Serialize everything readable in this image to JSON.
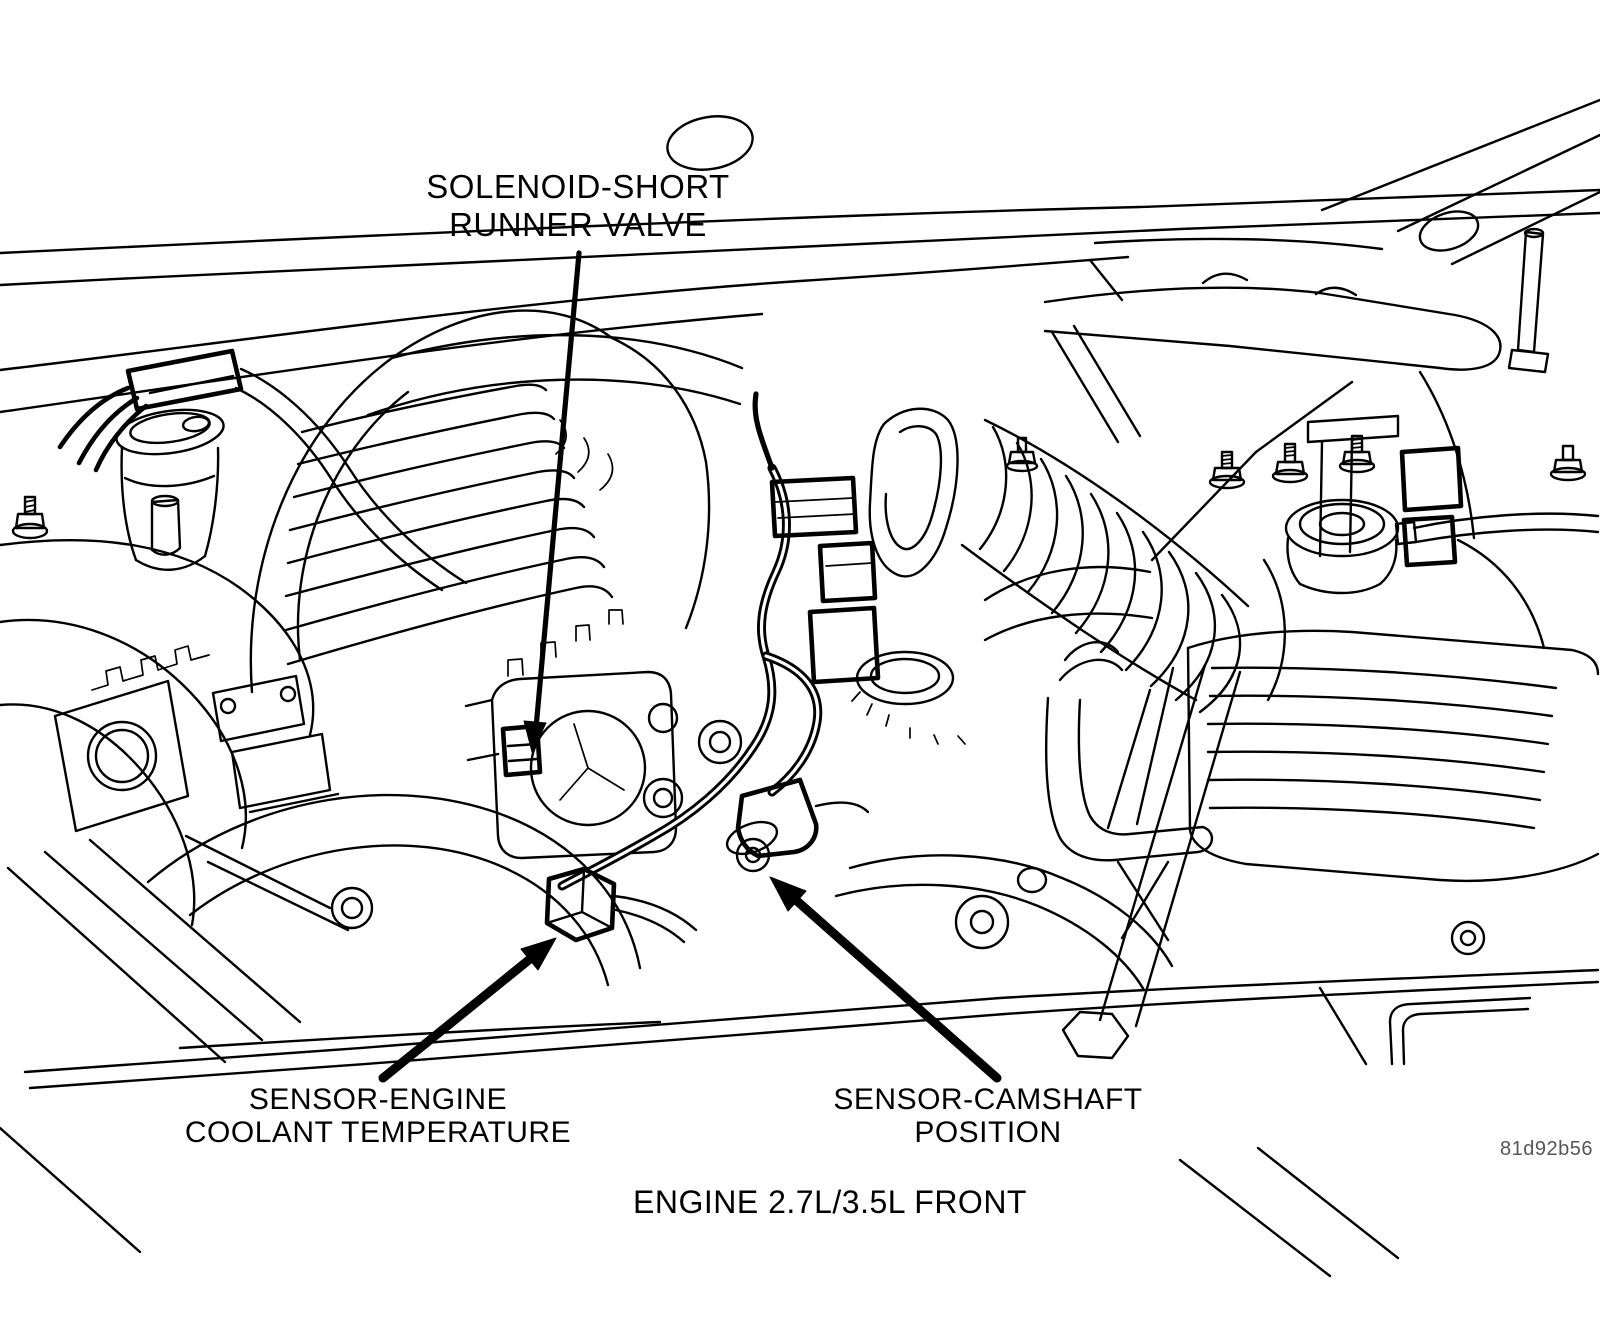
{
  "figure": {
    "type": "engine-bay-line-illustration",
    "caption": "ENGINE 2.7L/3.5L FRONT",
    "figure_code": "81d92b56",
    "labels": {
      "solenoid": {
        "line1": "SOLENOID-SHORT",
        "line2": "RUNNER VALVE"
      },
      "coolant": {
        "line1": "SENSOR-ENGINE",
        "line2": "COOLANT TEMPERATURE"
      },
      "camshaft": {
        "line1": "SENSOR-CAMSHAFT",
        "line2": "POSITION"
      }
    },
    "colors": {
      "ink": "#000000",
      "background": "#ffffff",
      "figure_code_text": "#565656"
    },
    "icons": [
      "down-arrow-icon",
      "up-right-arrow-icon",
      "up-left-arrow-icon"
    ]
  }
}
